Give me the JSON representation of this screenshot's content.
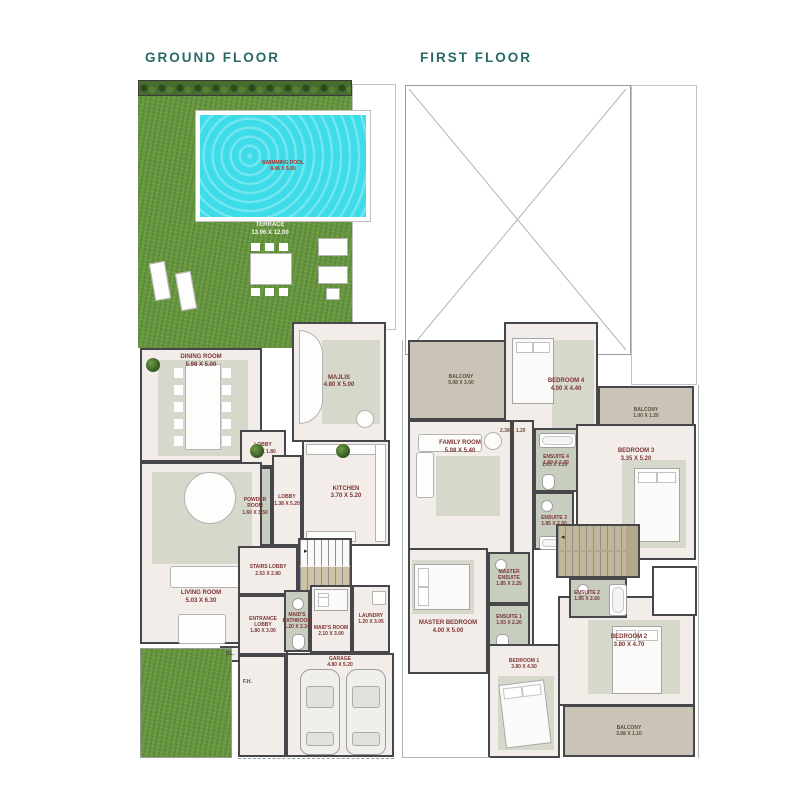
{
  "page": {
    "background": "#ffffff"
  },
  "colors": {
    "title_teal": "#266a68",
    "grass": "#68973f",
    "hedge": "#466d2d",
    "pool_water": "#3edce9",
    "wall": "#47474b",
    "floor": "#f3ede9",
    "rug": "#d5d8cb",
    "bathroom": "#c7cdbf",
    "balcony": "#cac4b6",
    "stairs_tan": "#b3a78c",
    "room_label": "#7d3434",
    "pool_label": "#a93226"
  },
  "ground": {
    "title": "GROUND FLOOR",
    "pool": {
      "name": "SWIMMING POOL",
      "dims": "8.46 X 5.00"
    },
    "terrace": {
      "name": "TERRACE",
      "dims": "13.06 X 12.00"
    },
    "rooms": [
      {
        "name": "DINING ROOM",
        "dims": "5.98 X 5.00"
      },
      {
        "name": "MAJLIS",
        "dims": "4.80 X 5.00"
      },
      {
        "name": "LOBBY",
        "dims": "1.68 X 1.80"
      },
      {
        "name": "POWDER ROOM",
        "dims": "1.60 X 3.50"
      },
      {
        "name": "LOBBY",
        "dims": "1.38 X 5.20"
      },
      {
        "name": "KITCHEN",
        "dims": "3.70 X 5.20"
      },
      {
        "name": "LIVING ROOM",
        "dims": "5.03 X 6.30"
      },
      {
        "name": "STAIRS LOBBY",
        "dims": "2.53 X 2.80"
      },
      {
        "name": "ENTRANCE LOBBY",
        "dims": "1.80 X 3.00"
      },
      {
        "name": "MAID'S BATHROOM",
        "dims": "1.20 X 2.24"
      },
      {
        "name": "MAID'S ROOM",
        "dims": "2.10 X 3.00"
      },
      {
        "name": "LAUNDRY",
        "dims": "1.20 X 3.05"
      },
      {
        "name": "GARAGE",
        "dims": "4.80 X 5.20"
      }
    ],
    "misc": {
      "closet": "CL.",
      "fire_hose": "F.H."
    }
  },
  "first": {
    "title": "FIRST FLOOR",
    "rooms": [
      {
        "name": "BALCONY",
        "dims": "5.08 X 3.00"
      },
      {
        "name": "BEDROOM 4",
        "dims": "4.00 X 4.40"
      },
      {
        "name": "BALCONY",
        "dims": "1.00 X 1.20"
      },
      {
        "name": "BEDROOM 3",
        "dims": "3.35 X 5.20"
      },
      {
        "name": "ENSUITE 4",
        "dims": "1.60 X 2.30"
      },
      {
        "name": "FAMILY ROOM",
        "dims": "5.08 X 5.40"
      },
      {
        "name": "ENSUITE 3",
        "dims": "1.85 X 2.50"
      },
      {
        "name": "MASTER ENSUITE",
        "dims": "1.85 X 2.25"
      },
      {
        "name": "MASTER BEDROOM",
        "dims": "4.00 X 5.00"
      },
      {
        "name": "ENSUITE 1",
        "dims": "1.93 X 2.20"
      },
      {
        "name": "ENSUITE 2",
        "dims": "1.85 X 2.60"
      },
      {
        "name": "BEDROOM 2",
        "dims": "3.80 X 4.70"
      },
      {
        "name": "BEDROOM 1",
        "dims": "3.80 X 4.50"
      },
      {
        "name": "BALCONY",
        "dims": "3.08 X 1.10"
      }
    ],
    "dim_labels": [
      "2.38 X 1.20",
      "1.63 X 1.20"
    ]
  }
}
